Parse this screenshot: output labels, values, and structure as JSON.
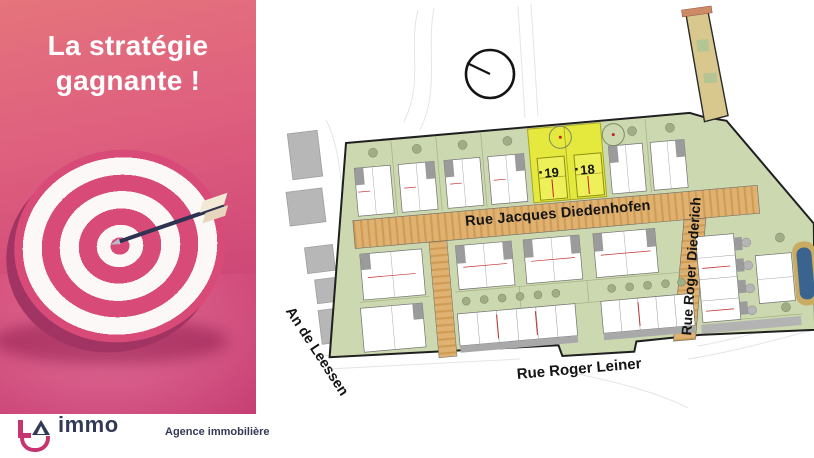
{
  "left_panel": {
    "headline": {
      "line1": "La stratégie",
      "line2": "gagnante !"
    },
    "logo": {
      "letters": "LA",
      "name": "immo",
      "tagline": "Agence immobilière"
    },
    "colors": {
      "panel_top": "#e5747c",
      "panel_bottom": "#c43d72",
      "brand_pink": "#c6356f",
      "brand_navy": "#323a56"
    }
  },
  "site_plan": {
    "streets": {
      "main": "Rue Jacques Diedenhofen",
      "east": "Rue Roger Diederich",
      "south": "Rue Roger Leiner",
      "west": "An de Leessen"
    },
    "highlighted_plots": [
      {
        "number": "19"
      },
      {
        "number": "18"
      }
    ],
    "colors": {
      "plot_green": "#ccd8af",
      "street_tan": "#e0b272",
      "highlight_yellow": "#e5e93d"
    }
  }
}
